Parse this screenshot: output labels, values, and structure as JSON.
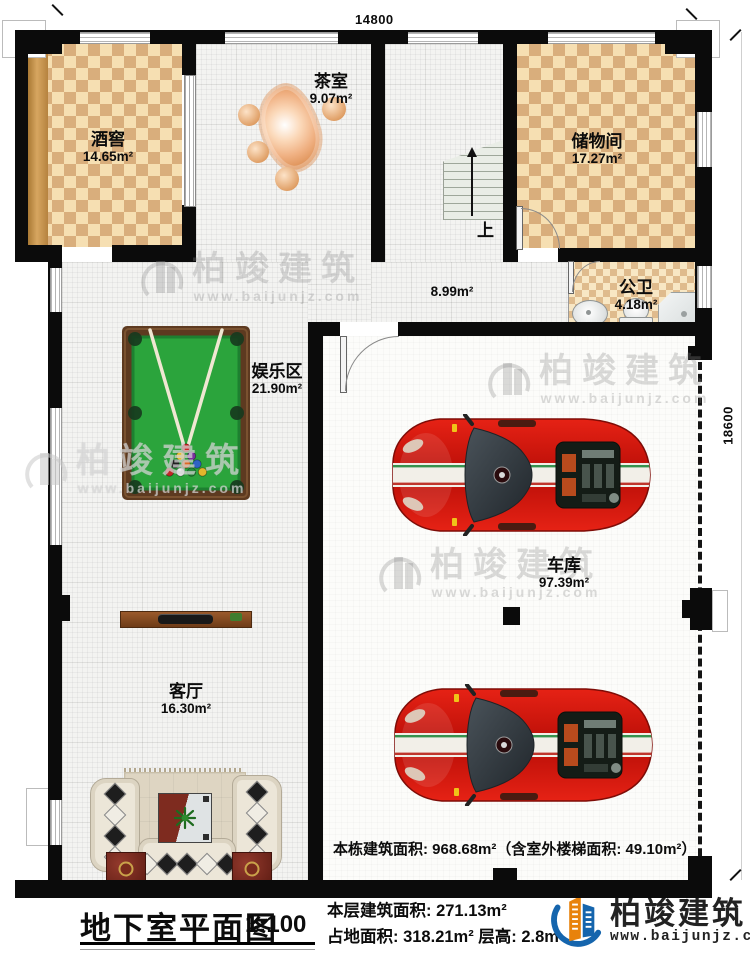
{
  "plan": {
    "dim_top": "14800",
    "dim_right": "18600",
    "stairs_up_label": "上",
    "note": "本栋建筑面积: 968.68m²（含室外楼梯面积: 49.10m²）",
    "rooms": {
      "wine": {
        "name": "酒窖",
        "area": "14.65m²"
      },
      "tea": {
        "name": "茶室",
        "area": "9.07m²"
      },
      "storage": {
        "name": "储物间",
        "area": "17.27m²"
      },
      "bathroom": {
        "name": "公卫",
        "area": "4.18m²"
      },
      "corridor": {
        "area": "8.99m²"
      },
      "entertainment": {
        "name": "娱乐区",
        "area": "21.90m²"
      },
      "living": {
        "name": "客厅",
        "area": "16.30m²"
      },
      "garage": {
        "name": "车库",
        "area": "97.39m²"
      }
    }
  },
  "watermark": {
    "brand": "柏竣建筑",
    "url": "www.baijunjz.com"
  },
  "footer": {
    "title": "地下室平面图",
    "scale": "1:100",
    "stats_line1": "本层建筑面积: 271.13m²",
    "stats_line2": "占地面积: 318.21m²  层高: 2.8m",
    "brand": "柏竣建筑",
    "website": "www.baijunjz.com"
  },
  "colors": {
    "brand_blue": "#1565ad",
    "brand_orange": "#e8820c",
    "car_red": "#cc1a12",
    "felt_green": "#2ba43c",
    "wall_black": "#0b0b0b"
  }
}
